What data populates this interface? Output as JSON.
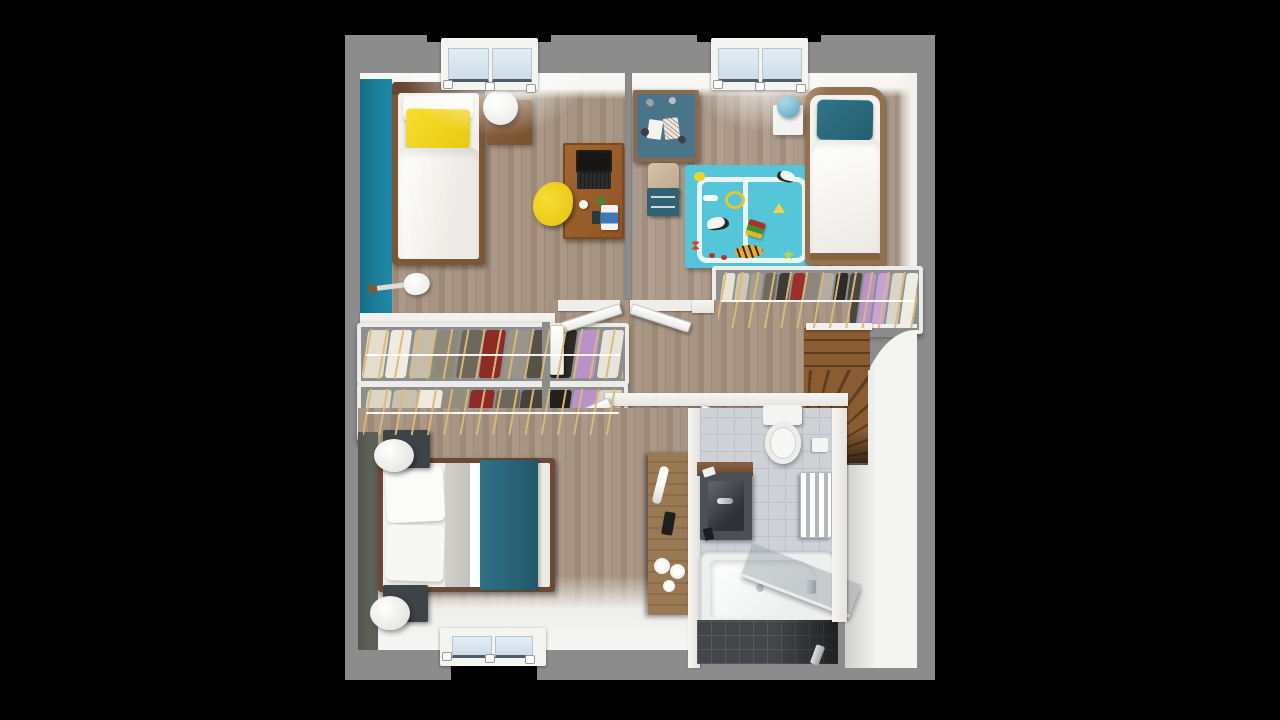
{
  "scene": {
    "type": "3d-floor-plan-render",
    "view": "top-down-dollhouse",
    "background_color": "#000000",
    "rooms": [
      {
        "name": "bedroom-1",
        "position": "top-left",
        "accent_wall_color": "#1b7f9c",
        "floor": "wood",
        "furniture": [
          "single-bed-with-yellow-pillow",
          "round-white-lamp",
          "wood-nightstand",
          "desk-with-laptop",
          "yellow-desk-chair",
          "electric-guitar-on-floor"
        ]
      },
      {
        "name": "kids-bedroom",
        "position": "top-right",
        "floor": "wood",
        "furniture": [
          "craft-desk-teal-top",
          "desk-chair-with-drawers",
          "turquoise-play-rug",
          "single-bed-teal-pillow",
          "white-nightstand",
          "blue-lamp"
        ],
        "rug_toys": [
          "bone",
          "duck",
          "ring",
          "dalmatian-dog",
          "toy-truck",
          "tiger-plush",
          "cheese-wedge",
          "butterfly",
          "ladybugs",
          "star",
          "second-dog"
        ]
      },
      {
        "name": "kids-closet",
        "position": "right-middle",
        "contents": "hanging-clothes-on-rail"
      },
      {
        "name": "dressing-area",
        "position": "left-middle",
        "contents": "two-open-clothes-racks"
      },
      {
        "name": "hallway",
        "position": "center",
        "floor": "wood",
        "doors": 5
      },
      {
        "name": "staircase",
        "position": "right-middle",
        "material": "wood",
        "shape": "winder-curved"
      },
      {
        "name": "bedroom-3",
        "position": "bottom-left",
        "accent_wall_color": "#5c6157",
        "floor": "wood",
        "furniture": [
          "double-bed-teal-runner",
          "dark-nightstand-x2",
          "round-white-lamp-x2",
          "tall-wood-console-with-towels"
        ]
      },
      {
        "name": "bathroom",
        "position": "bottom-right",
        "floor": "gray-tile",
        "furniture": [
          "toilet",
          "dark-vanity-basin",
          "towel-radiator",
          "bathtub-with-glass-screen"
        ]
      }
    ],
    "windows": [
      {
        "wall": "top",
        "room": "bedroom-1",
        "panes": 2
      },
      {
        "wall": "top",
        "room": "kids-bedroom",
        "panes": 2
      },
      {
        "wall": "bottom",
        "room": "bedroom-3",
        "panes": 2
      }
    ],
    "palette": {
      "outer_wall": "#8c8c8c",
      "inner_wall": "#f2f1ee",
      "floor_wood": "#a3907f",
      "floor_wood_kids": "#ac9a8a",
      "accent_teal_wall": "#1b7f9c",
      "accent_green_wall": "#5c6157",
      "bed_frame_dark": "#6b4936",
      "bed_frame_mid": "#7b5738",
      "bed_frame_kids": "#93714f",
      "duvet_white": "#f4f3f0",
      "pillow_yellow": "#f2d41f",
      "textile_teal": "#2b6b7e",
      "blanket_gray": "#c9c7c2",
      "desk_wood": "#995f2b",
      "laptop_black": "#1e1e1e",
      "chair_yellow": "#f0cf1e",
      "kids_desk_top": "#49758a",
      "kids_rug": "#55c5da",
      "rug_path_white": "#e9f7f9",
      "lamp_blue": "#5aa9c8",
      "stairs_wood": "#8a5c32",
      "stair_riser": "#5f3d1e",
      "tile_light": "#ced2d6",
      "tile_dark": "#434548",
      "vanity_basin": "#4c5054",
      "window_glass": "#d9e7f1",
      "hanger_beige": "#d8ba7a"
    },
    "clothes_colors": {
      "kids_closet": [
        "#e9e3d3",
        "#cfc6b4",
        "#a79e8e",
        "#6f695e",
        "#3f3b34",
        "#9c2f28",
        "#8d867c",
        "#b5ada1",
        "#2e2b27",
        "#4a453e",
        "#b892c8",
        "#caa0d8",
        "#d9d3c8",
        "#efece4"
      ],
      "dressing_rack_top": [
        "#e5ddcb",
        "#f0ebe1",
        "#c5bcaa",
        "#8f8778",
        "#6e675c",
        "#8e2b26",
        "#9b948a",
        "#575148",
        "#2d2a26",
        "#b892c8",
        "#e8e4da"
      ],
      "dressing_rack_bottom": [
        "#ded6c4",
        "#c9c0ae",
        "#efe9de",
        "#958d7e",
        "#8e2b26",
        "#6e675c",
        "#47423b",
        "#23201d",
        "#b892c8",
        "#d9d2c6"
      ]
    }
  }
}
